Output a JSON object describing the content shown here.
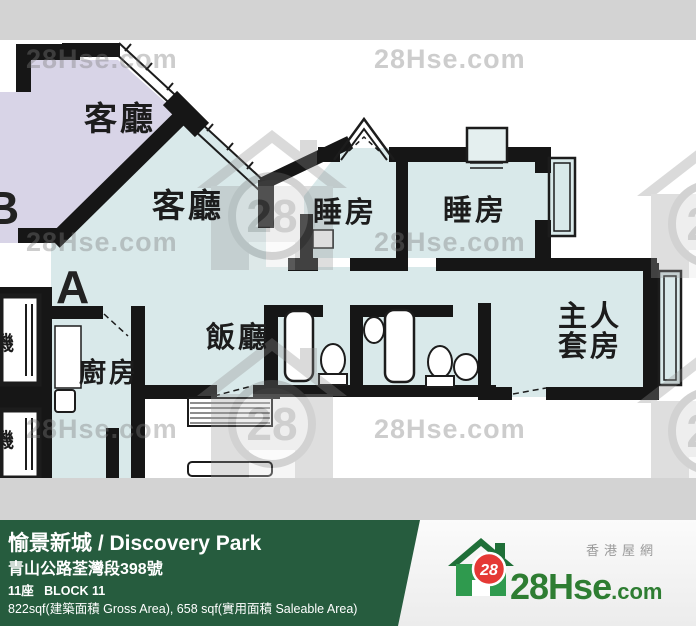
{
  "plan": {
    "unit_a_letter": "A",
    "unit_b_letter": "B",
    "rooms": {
      "living_b": "客廳",
      "living_a": "客廳",
      "bedroom_1": "睡房",
      "bedroom_2": "睡房",
      "dining": "飯廳",
      "kitchen": "廚房",
      "master_line_1": "主人",
      "master_line_2": "套房",
      "lift_1": "機",
      "lift_2": "機"
    }
  },
  "watermarks": {
    "text": "28Hse.com",
    "badge": "28"
  },
  "info_bar": {
    "title": "愉景新城 / Discovery Park",
    "address": "青山公路荃灣段398號",
    "block": "11座   BLOCK 11",
    "area": "822sqf(建築面積 Gross Area), 658 sqf(實用面積 Saleable Area)"
  },
  "brand": {
    "tagline_zh": "香港屋網",
    "badge": "28",
    "name_main": "28Hse",
    "name_suffix": ".com"
  },
  "colors": {
    "unit_a_fill": "#d9e9ea",
    "unit_b_fill": "#d8d4e7",
    "wall": "#161616",
    "band_gray": "#d3d3d3",
    "bar_green": "#265c3e",
    "logo_green": "#2e7d32",
    "badge_red": "#e53935"
  }
}
